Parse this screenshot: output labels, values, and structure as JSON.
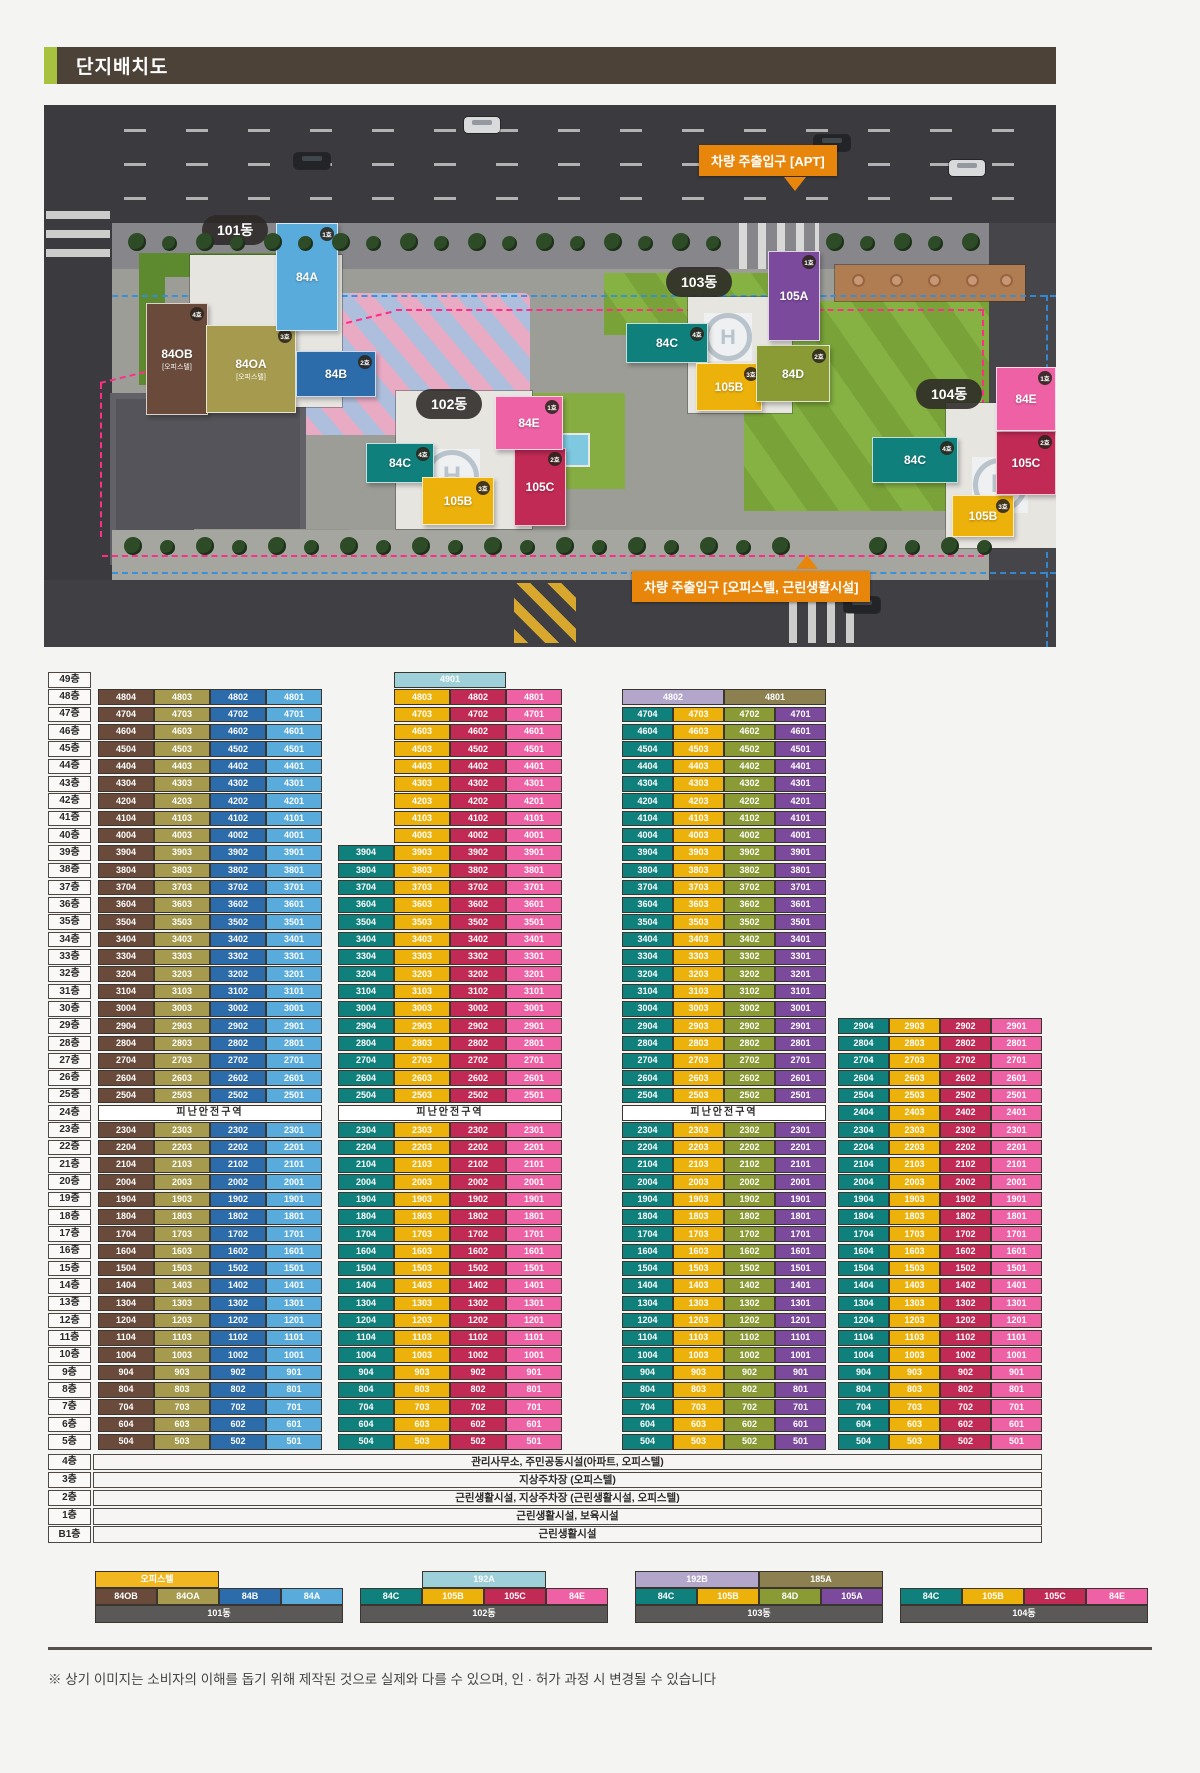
{
  "header": {
    "title": "단지배치도"
  },
  "site_plan": {
    "entrances": [
      {
        "id": "apt",
        "label": "차량 주출입구 [APT]"
      },
      {
        "id": "officetel",
        "label": "차량 주출입구 [오피스텔, 근린생활시설]"
      }
    ],
    "building_pills": [
      "101동",
      "102동",
      "103동",
      "104동"
    ],
    "helipad_letter": "H",
    "wings": [
      {
        "dong": "101동",
        "label": "84OB",
        "sub": "[오피스텔]",
        "badge": "4호",
        "color": "#6a4b3b"
      },
      {
        "dong": "101동",
        "label": "84OA",
        "sub": "[오피스텔]",
        "badge": "3호",
        "color": "#a59a4e"
      },
      {
        "dong": "101동",
        "label": "84B",
        "badge": "2호",
        "color": "#2c6cab"
      },
      {
        "dong": "101동",
        "label": "84A",
        "badge": "1호",
        "color": "#58abdb"
      },
      {
        "dong": "102동",
        "label": "84C",
        "badge": "4호",
        "color": "#10807d"
      },
      {
        "dong": "102동",
        "label": "105B",
        "badge": "3호",
        "color": "#edb10b"
      },
      {
        "dong": "102동",
        "label": "105C",
        "badge": "2호",
        "color": "#c22a56"
      },
      {
        "dong": "102동",
        "label": "84E",
        "badge": "1호",
        "color": "#ee61a5"
      },
      {
        "dong": "103동",
        "label": "84C",
        "badge": "4호",
        "color": "#10807d"
      },
      {
        "dong": "103동",
        "label": "105B",
        "badge": "3호",
        "color": "#edb10b"
      },
      {
        "dong": "103동",
        "label": "84D",
        "badge": "2호",
        "color": "#8a9a35"
      },
      {
        "dong": "103동",
        "label": "105A",
        "badge": "1호",
        "color": "#7b4a9d"
      },
      {
        "dong": "104동",
        "label": "84C",
        "badge": "4호",
        "color": "#10807d"
      },
      {
        "dong": "104동",
        "label": "105B",
        "badge": "3호",
        "color": "#edb10b"
      },
      {
        "dong": "104동",
        "label": "105C",
        "badge": "2호",
        "color": "#c22a56"
      },
      {
        "dong": "104동",
        "label": "84E",
        "badge": "1호",
        "color": "#ee61a5"
      }
    ]
  },
  "stack": {
    "floor_axis": [
      "49층",
      "48층",
      "47층",
      "46층",
      "45층",
      "44층",
      "43층",
      "42층",
      "41층",
      "40층",
      "39층",
      "38층",
      "37층",
      "36층",
      "35층",
      "34층",
      "33층",
      "32층",
      "31층",
      "30층",
      "29층",
      "28층",
      "27층",
      "26층",
      "25층",
      "24층",
      "23층",
      "22층",
      "21층",
      "20층",
      "19층",
      "18층",
      "17층",
      "16층",
      "15층",
      "14층",
      "13층",
      "12층",
      "11층",
      "10층",
      "9층",
      "8층",
      "7층",
      "6층",
      "5층"
    ],
    "refuge_label": "피난안전구역",
    "unit_number_format": "{floor}{suffix}",
    "groups": [
      {
        "name": "101동",
        "refuge_floor": 24,
        "columns": [
          {
            "type": "84OB",
            "suffix": "04",
            "color": "#6a4b3b",
            "top_floor": 48,
            "bottom_floor": 5
          },
          {
            "type": "84OA",
            "suffix": "03",
            "color": "#a59a4e",
            "top_floor": 48,
            "bottom_floor": 5
          },
          {
            "type": "84B",
            "suffix": "02",
            "color": "#2c6cab",
            "top_floor": 48,
            "bottom_floor": 5
          },
          {
            "type": "84A",
            "suffix": "01",
            "color": "#58abdb",
            "top_floor": 48,
            "bottom_floor": 5
          }
        ],
        "spans": []
      },
      {
        "name": "102동",
        "refuge_floor": 24,
        "columns": [
          {
            "type": "84C",
            "suffix": "04",
            "color": "#10807d",
            "top_floor": 39,
            "bottom_floor": 5
          },
          {
            "type": "105B",
            "suffix": "03",
            "color": "#edb10b",
            "top_floor": 48,
            "bottom_floor": 5
          },
          {
            "type": "105C",
            "suffix": "02",
            "color": "#c22a56",
            "top_floor": 48,
            "bottom_floor": 5
          },
          {
            "type": "84E",
            "suffix": "01",
            "color": "#ee61a5",
            "top_floor": 48,
            "bottom_floor": 5
          }
        ],
        "spans": [
          {
            "unit": "4901",
            "type": "192A",
            "floor": 49,
            "col_start": 1,
            "col_span": 2,
            "color": "#9ed0da"
          }
        ]
      },
      {
        "name": "103동",
        "refuge_floor": 24,
        "columns": [
          {
            "type": "84C",
            "suffix": "04",
            "color": "#10807d",
            "top_floor": 47,
            "bottom_floor": 5
          },
          {
            "type": "105B",
            "suffix": "03",
            "color": "#edb10b",
            "top_floor": 47,
            "bottom_floor": 5
          },
          {
            "type": "84D",
            "suffix": "02",
            "color": "#8a9a35",
            "top_floor": 47,
            "bottom_floor": 5
          },
          {
            "type": "105A",
            "suffix": "01",
            "color": "#7b4a9d",
            "top_floor": 47,
            "bottom_floor": 5
          }
        ],
        "spans": [
          {
            "unit": "4802",
            "type": "192B",
            "floor": 48,
            "col_start": 0,
            "col_span": 2,
            "color": "#b3a6cb"
          },
          {
            "unit": "4801",
            "type": "185A",
            "floor": 48,
            "col_start": 2,
            "col_span": 2,
            "color": "#8c7f50"
          }
        ]
      },
      {
        "name": "104동",
        "refuge_floor": null,
        "columns": [
          {
            "type": "84C",
            "suffix": "04",
            "color": "#10807d",
            "top_floor": 29,
            "bottom_floor": 5
          },
          {
            "type": "105B",
            "suffix": "03",
            "color": "#edb10b",
            "top_floor": 29,
            "bottom_floor": 5
          },
          {
            "type": "105C",
            "suffix": "02",
            "color": "#c22a56",
            "top_floor": 29,
            "bottom_floor": 5
          },
          {
            "type": "84E",
            "suffix": "01",
            "color": "#ee61a5",
            "top_floor": 29,
            "bottom_floor": 5
          }
        ],
        "spans": []
      }
    ],
    "lower_floors": [
      {
        "label": "4층",
        "text": "관리사무소, 주민공동시설(아파트, 오피스텔)"
      },
      {
        "label": "3층",
        "text": "지상주차장 (오피스텔)"
      },
      {
        "label": "2층",
        "text": "근린생활시설, 지상주차장 (근린생활시설, 오피스텔)"
      },
      {
        "label": "1층",
        "text": "근린생활시설, 보육시설"
      },
      {
        "label": "B1층",
        "text": "근린생활시설"
      }
    ]
  },
  "legend": {
    "blocks": [
      {
        "name": "101동",
        "headers": [
          {
            "label": "오피스텔",
            "color": "#f2b620",
            "col_start": 0,
            "col_span": 2
          }
        ],
        "cells": [
          {
            "label": "84OB",
            "color": "#6a4b3b"
          },
          {
            "label": "84OA",
            "color": "#a59a4e"
          },
          {
            "label": "84B",
            "color": "#2c6cab"
          },
          {
            "label": "84A",
            "color": "#58abdb"
          }
        ]
      },
      {
        "name": "102동",
        "headers": [
          {
            "label": "192A",
            "color": "#9ed0da",
            "col_start": 1,
            "col_span": 2
          }
        ],
        "cells": [
          {
            "label": "84C",
            "color": "#10807d"
          },
          {
            "label": "105B",
            "color": "#edb10b"
          },
          {
            "label": "105C",
            "color": "#c22a56"
          },
          {
            "label": "84E",
            "color": "#ee61a5"
          }
        ]
      },
      {
        "name": "103동",
        "headers": [
          {
            "label": "192B",
            "color": "#b3a6cb",
            "col_start": 0,
            "col_span": 2
          },
          {
            "label": "185A",
            "color": "#8c7f50",
            "col_start": 2,
            "col_span": 2
          }
        ],
        "cells": [
          {
            "label": "84C",
            "color": "#10807d"
          },
          {
            "label": "105B",
            "color": "#edb10b"
          },
          {
            "label": "84D",
            "color": "#8a9a35"
          },
          {
            "label": "105A",
            "color": "#7b4a9d"
          }
        ]
      },
      {
        "name": "104동",
        "headers": [],
        "cells": [
          {
            "label": "84C",
            "color": "#10807d"
          },
          {
            "label": "105B",
            "color": "#edb10b"
          },
          {
            "label": "105C",
            "color": "#c22a56"
          },
          {
            "label": "84E",
            "color": "#ee61a5"
          }
        ]
      }
    ]
  },
  "footer": {
    "disclaimer": "※ 상기 이미지는 소비자의 이해를 돕기 위해 제작된 것으로 실제와 다를 수 있으며, 인 · 허가 과정 시 변경될 수 있습니다"
  }
}
